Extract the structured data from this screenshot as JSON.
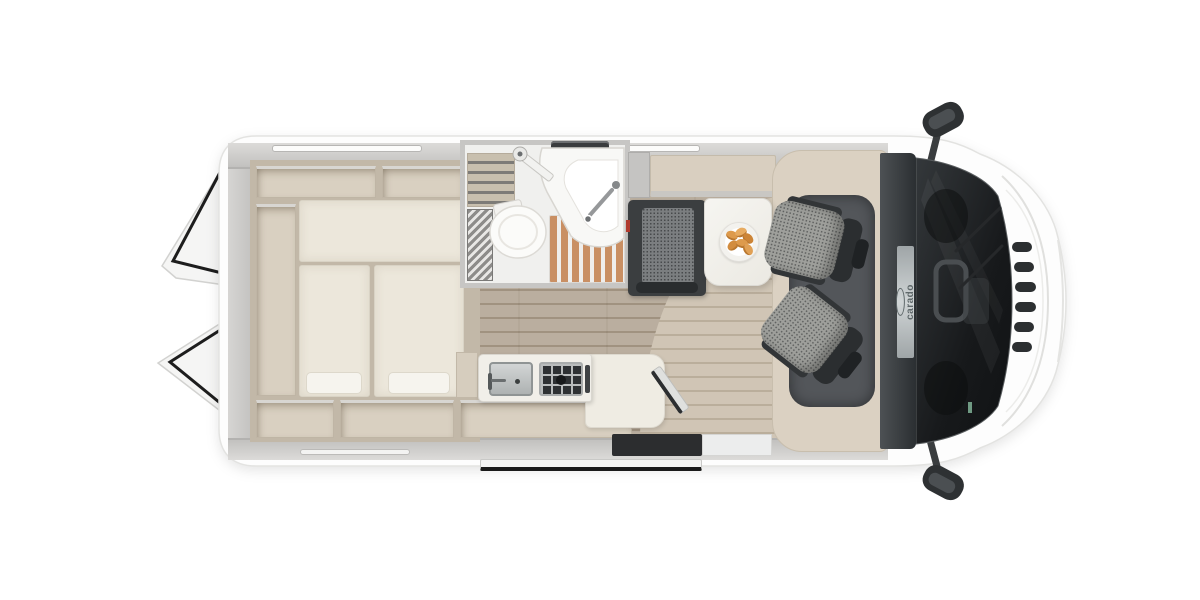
{
  "meta": {
    "type": "motorhome floor plan, top-down product render",
    "orientation": "front of vehicle on the right"
  },
  "brand": {
    "logo_text": "carado"
  },
  "palette": {
    "background": "#ffffff",
    "body_shell": "#fdfdfd",
    "interior_walls": "#c9c8c6",
    "cabinetry_taupe": "#d9d0c1",
    "mattress_cream": "#ece7db",
    "floor_laminate": "#b2a594",
    "floor_laminate_light": "#c9bdab",
    "shower_wood_slats": "#c98f63",
    "bench_dark": "#3b3e40",
    "seat_fabric_gray": "#9e9f9b",
    "seat_trim_dark": "#2b2e30",
    "cab_roof_band": "#2b2f32",
    "table_white": "#f3f2ee",
    "croissant_orange": "#dd9a4c",
    "windshield_dark": "#1a1d1f",
    "seatbelt_accent_red": "#b03a2e"
  },
  "exterior": {
    "rear_doors": "open (two door panels swung out at rear, black seals)",
    "side_mirrors_count": 2,
    "roof_window_strips": 3,
    "front_grille_slats": 6,
    "sliding_door_rail": "open sliding door parked below side entry",
    "windshield": "panoramic, dashboard and steering wheel visible"
  },
  "areas": {
    "rear_bedroom": {
      "name": "rear-bedroom",
      "features": [
        "transverse-double-bed",
        "two-single-mattresses",
        "two-pillows",
        "perimeter-storage-compartments"
      ]
    },
    "bathroom": {
      "name": "bathroom",
      "features": [
        "cassette-toilet",
        "corner-washbasin-with-faucet",
        "shower-tray-with-wooden-slats",
        "folding-door-with-hinge",
        "tambour-screen",
        "roof-vent"
      ]
    },
    "kitchen": {
      "name": "kitchen",
      "features": [
        "stainless-sink-with-faucet",
        "two-burner-hob-with-grate",
        "worktop-extension",
        "folding-flap",
        "base-cabinets"
      ]
    },
    "dinette": {
      "name": "dinette",
      "features": [
        "two-seat-bench-with-seatbelt-detail",
        "white-table",
        "plate-of-croissants",
        "swivel-captain-chair-front",
        "swivel-captain-chair-rear"
      ],
      "croissants_on_plate": 6
    },
    "cab": {
      "name": "driver-cab",
      "features": [
        "dark-roof-band",
        "brand-plaque",
        "windshield",
        "steering-wheel",
        "two-wipers",
        "dark-cab-mat"
      ]
    },
    "entry": {
      "name": "side-entry",
      "features": [
        "dark-threshold-step",
        "step-well",
        "sliding-door-rail"
      ]
    }
  }
}
